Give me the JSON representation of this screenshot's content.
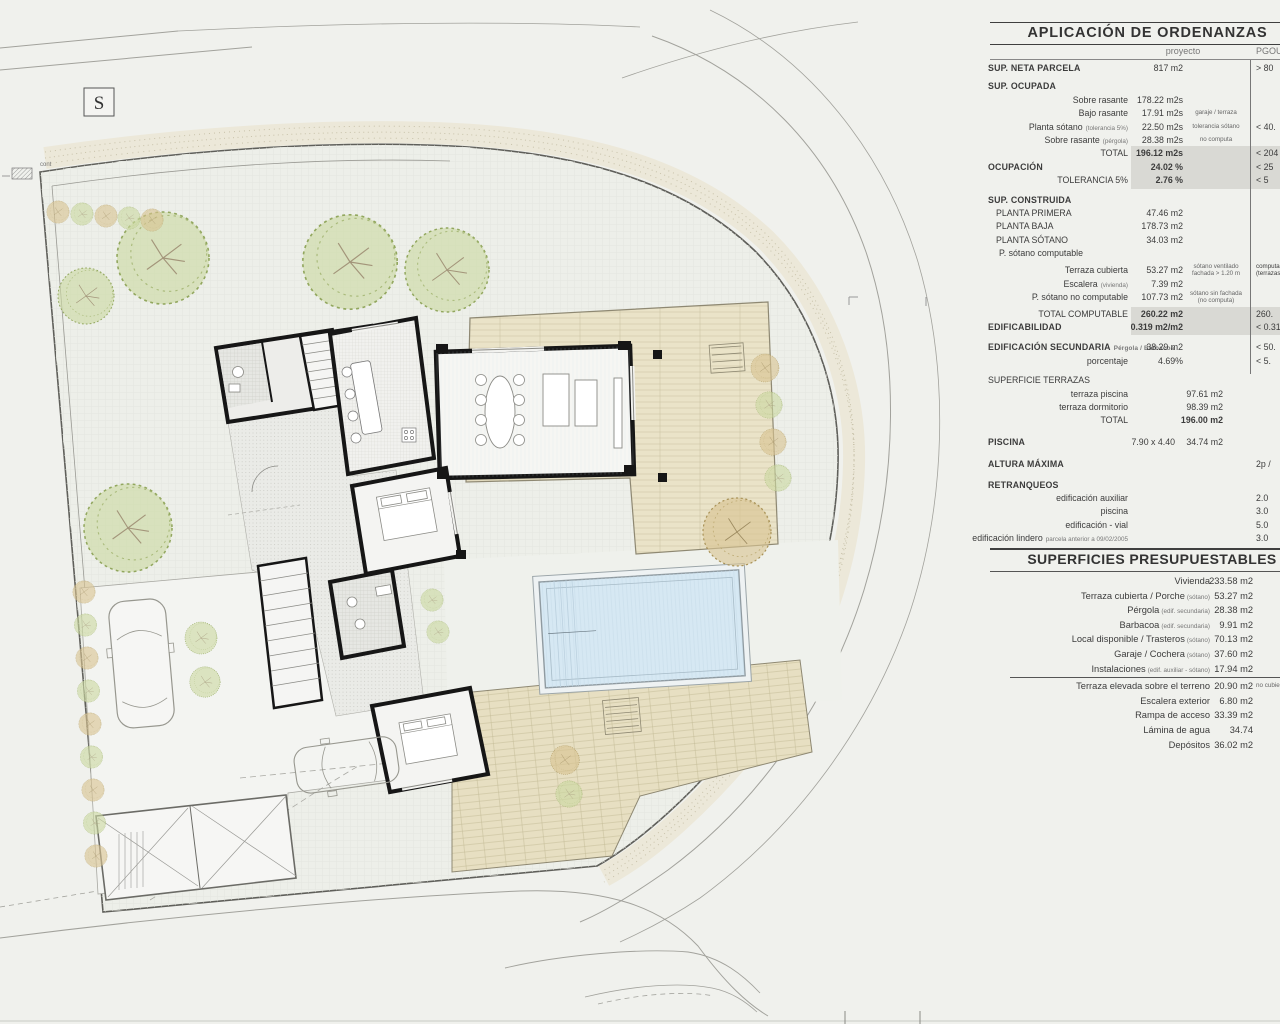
{
  "plan": {
    "s_marker": "S",
    "cont_label": "cont"
  },
  "colors": {
    "highlight": "#d9d9d4",
    "deck": "#eae3c8",
    "pool": "#d6e8f3",
    "tree_green": "#ccd8a2",
    "tree_olive": "#d8c492",
    "wall": "#161616"
  },
  "ordenanzas": {
    "title": "APLICACIÓN DE ORDENANZAS",
    "col_proyecto": "proyecto",
    "col_pgou": "PGOU",
    "rows": [
      {
        "label": "SUP. NETA PARCELA",
        "value": "817 m2",
        "pgou": "> 80",
        "cls": "sec"
      },
      {
        "label": "SUP. OCUPADA",
        "cls": "sec g5"
      },
      {
        "label": "Sobre rasante",
        "value": "178.22 m2s"
      },
      {
        "label": "Bajo rasante",
        "value": "17.91 m2s",
        "note": "garaje / terraza"
      },
      {
        "label": "Planta sótano",
        "sub": "(tolerancia 5%)",
        "value": "22.50 m2s",
        "note": "tolerancia sótano",
        "pgou": "< 40."
      },
      {
        "label": "Sobre rasante",
        "sub": "(pérgola)",
        "value": "28.38 m2s",
        "note": "no computa"
      },
      {
        "label": "TOTAL",
        "value": "196.12 m2s",
        "pgou": "< 204",
        "cls": "hl valb"
      },
      {
        "label": "OCUPACIÓN",
        "value": "24.02 %",
        "pgou": "< 25",
        "cls": "sec hl valb"
      },
      {
        "label": "TOLERANCIA 5%",
        "value": "2.76 %",
        "pgou": "< 5",
        "cls": "hl valb"
      },
      {
        "label": "SUP. CONSTRUIDA",
        "cls": "sec g6"
      },
      {
        "label": "PLANTA PRIMERA",
        "value": "47.46 m2",
        "cls": "ind"
      },
      {
        "label": "PLANTA BAJA",
        "value": "178.73 m2",
        "cls": "ind"
      },
      {
        "label": "PLANTA SÓTANO",
        "value": "34.03 m2",
        "cls": "ind"
      },
      {
        "label": "P. sótano computable",
        "cls": "ind2"
      },
      {
        "label": "Terraza cubierta",
        "value": "53.27 m2",
        "note": "sótano ventilado\nfachada > 1.20 m",
        "pgou": "computa\n(terrazas",
        "cls": "g4 pgsm"
      },
      {
        "label": "Escalera",
        "sub": "(vivienda)",
        "value": "7.39 m2"
      },
      {
        "label": "P. sótano no computable",
        "value": "107.73 m2",
        "note": "sótano sin fachada\n(no computa)"
      },
      {
        "label": "TOTAL COMPUTABLE",
        "value": "260.22 m2",
        "pgou": "260.",
        "cls": "hl valb g3"
      },
      {
        "label": "EDIFICABILIDAD",
        "value": "0.319 m2/m2",
        "pgou": "< 0.319",
        "cls": "sec hl valb"
      },
      {
        "label": "EDIFICACIÓN SECUNDARIA",
        "sub": "Pérgola / Barbacoa",
        "value": "38.29 m2",
        "pgou": "< 50.",
        "cls": "sec g7"
      },
      {
        "label": "porcentaje",
        "value": "4.69%",
        "pgou": "< 5."
      },
      {
        "label": "SUPERFICIE TERRAZAS",
        "cls": "secl g6"
      },
      {
        "label": "terraza piscina",
        "value": "97.61 m2",
        "cls": "vr"
      },
      {
        "label": "terraza dormitorio",
        "value": "98.39 m2",
        "cls": "vr"
      },
      {
        "label": "TOTAL",
        "value": "196.00 m2",
        "cls": "vr valb"
      },
      {
        "label": "PISCINA",
        "mid": "7.90 x 4.40",
        "value": "34.74 m2",
        "cls": "sec vr g8"
      },
      {
        "label": "ALTURA MÁXIMA",
        "pgou": "2p / ",
        "cls": "sec g9"
      },
      {
        "label": "RETRANQUEOS",
        "cls": "sec g7"
      },
      {
        "label": "edificación auxiliar",
        "pgou": "2.0"
      },
      {
        "label": "piscina",
        "pgou": "3.0"
      },
      {
        "label": "edificación - vial",
        "pgou": "5.0"
      },
      {
        "label": "edificación lindero",
        "sub": "parcela anterior a 09/02/2005",
        "pgou": "3.0"
      }
    ]
  },
  "presupuestables": {
    "title": "SUPERFICIES PRESUPUESTABLES - TOTAL",
    "rows": [
      {
        "label": "Vivienda",
        "value": "233.58 m2"
      },
      {
        "label": "Terraza cubierta / Porche",
        "sub": "(sótano)",
        "value": "53.27 m2"
      },
      {
        "label": "Pérgola",
        "sub": "(edif. secundaria)",
        "value": "28.38 m2"
      },
      {
        "label": "Barbacoa",
        "sub": "(edif. secundaria)",
        "value": "9.91 m2"
      },
      {
        "label": "Local disponible / Trasteros",
        "sub": "(sótano)",
        "value": "70.13 m2"
      },
      {
        "label": "Garaje / Cochera",
        "sub": "(sótano)",
        "value": "37.60 m2"
      },
      {
        "label": "Instalaciones",
        "sub": "(edif. auxiliar - sótano)",
        "value": "17.94 m2"
      },
      {
        "label": "Terraza elevada sobre el terreno",
        "value": "20.90 m2",
        "note": "no cubierta",
        "cls": "rule"
      },
      {
        "label": "Escalera exterior",
        "value": "6.80 m2"
      },
      {
        "label": "Rampa de acceso",
        "value": "33.39 m2"
      },
      {
        "label": "Lámina de agua",
        "value": "34.74"
      },
      {
        "label": "Depósitos",
        "value": "36.02 m2"
      }
    ]
  }
}
